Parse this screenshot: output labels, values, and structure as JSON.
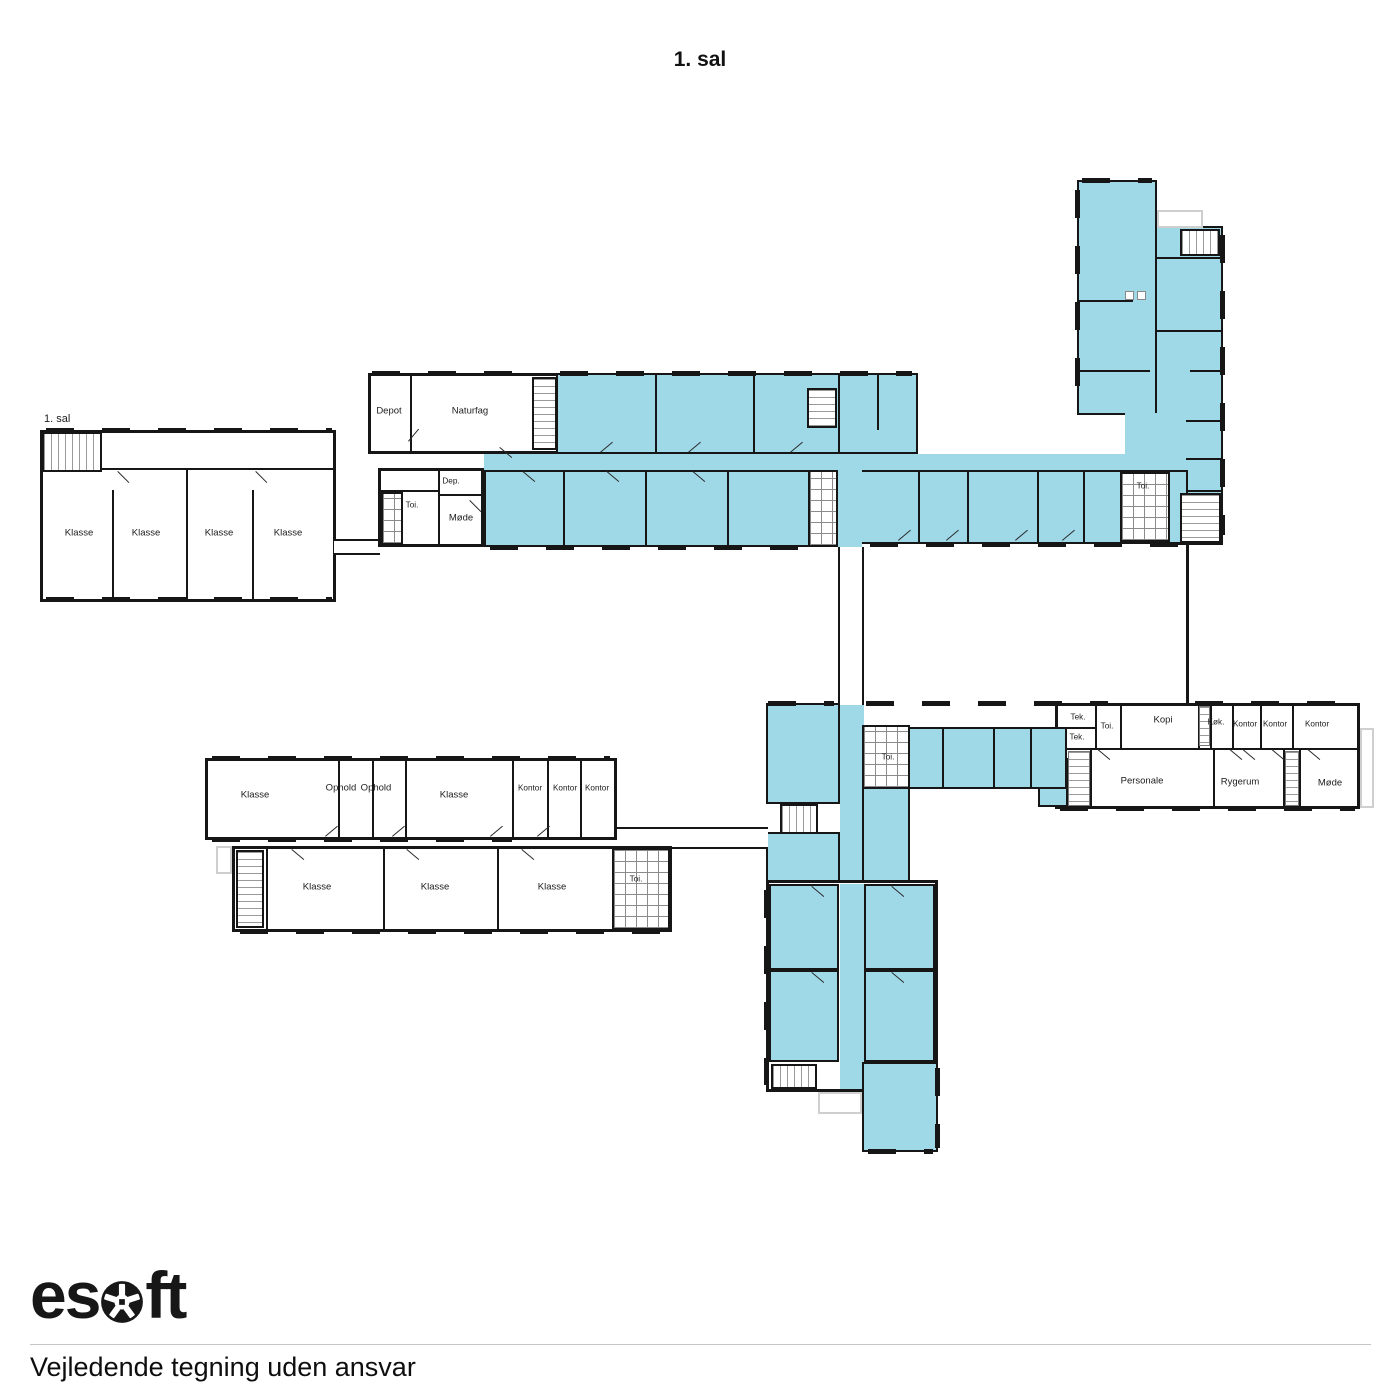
{
  "title": "1. sal",
  "plan": {
    "floor_tag": "1. sal",
    "highlight_color": "#9fd9e8",
    "wall_color": "#161616"
  },
  "room_labels": [
    {
      "text": "Klasse",
      "x": 79,
      "y": 533
    },
    {
      "text": "Klasse",
      "x": 146,
      "y": 533
    },
    {
      "text": "Klasse",
      "x": 219,
      "y": 533
    },
    {
      "text": "Klasse",
      "x": 288,
      "y": 533
    },
    {
      "text": "Depot",
      "x": 389,
      "y": 411
    },
    {
      "text": "Naturfag",
      "x": 470,
      "y": 411
    },
    {
      "text": "Dep.",
      "x": 451,
      "y": 481,
      "small": true
    },
    {
      "text": "Toi.",
      "x": 412,
      "y": 505,
      "small": true
    },
    {
      "text": "Møde",
      "x": 461,
      "y": 518
    },
    {
      "text": "Toi.",
      "x": 888,
      "y": 757,
      "small": true
    },
    {
      "text": "Toi.",
      "x": 1143,
      "y": 486,
      "small": true
    },
    {
      "text": "Tek.",
      "x": 1078,
      "y": 717,
      "small": true
    },
    {
      "text": "Tek.",
      "x": 1077,
      "y": 737,
      "small": true
    },
    {
      "text": "Toi.",
      "x": 1107,
      "y": 726,
      "small": true
    },
    {
      "text": "Kopi",
      "x": 1163,
      "y": 720
    },
    {
      "text": "Køk.",
      "x": 1216,
      "y": 722,
      "small": true
    },
    {
      "text": "Kontor",
      "x": 1245,
      "y": 724,
      "small": true
    },
    {
      "text": "Kontor",
      "x": 1275,
      "y": 724,
      "small": true
    },
    {
      "text": "Kontor",
      "x": 1317,
      "y": 724,
      "small": true
    },
    {
      "text": "Personale",
      "x": 1142,
      "y": 781
    },
    {
      "text": "Rygerum",
      "x": 1240,
      "y": 782
    },
    {
      "text": "Møde",
      "x": 1330,
      "y": 783
    },
    {
      "text": "Klasse",
      "x": 255,
      "y": 795
    },
    {
      "text": "Ophold",
      "x": 341,
      "y": 788
    },
    {
      "text": "Ophold",
      "x": 376,
      "y": 788
    },
    {
      "text": "Klasse",
      "x": 454,
      "y": 795
    },
    {
      "text": "Kontor",
      "x": 530,
      "y": 788,
      "small": true
    },
    {
      "text": "Kontor",
      "x": 565,
      "y": 788,
      "small": true
    },
    {
      "text": "Kontor",
      "x": 597,
      "y": 788,
      "small": true
    },
    {
      "text": "Klasse",
      "x": 317,
      "y": 887
    },
    {
      "text": "Klasse",
      "x": 435,
      "y": 887
    },
    {
      "text": "Klasse",
      "x": 552,
      "y": 887
    },
    {
      "text": "Toi.",
      "x": 636,
      "y": 879,
      "small": true
    }
  ],
  "footer": {
    "brand": "esoft",
    "brand_prefix": "es",
    "brand_suffix": "ft",
    "disclaimer": "Vejledende tegning uden ansvar"
  }
}
